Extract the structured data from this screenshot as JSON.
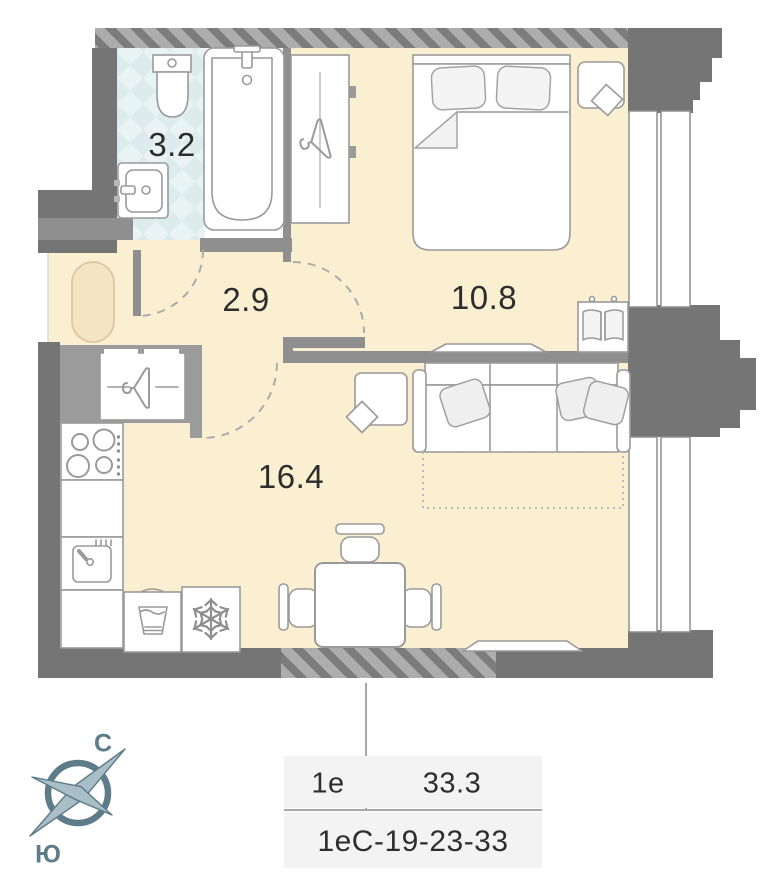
{
  "plan": {
    "type": "apartment-floor-plan",
    "rooms": {
      "bathroom": {
        "name": "bathroom",
        "area_label": "3.2"
      },
      "hallway": {
        "name": "hallway",
        "area_label": "2.9"
      },
      "bedroom": {
        "name": "bedroom",
        "area_label": "10.8"
      },
      "living_kitchen": {
        "name": "living-kitchen",
        "area_label": "16.4"
      }
    },
    "icons": [
      "toilet-icon",
      "bathtub-icon",
      "washbasin-icon",
      "hanger-icon",
      "bed-icon",
      "pillow-icon",
      "nightstand-icon",
      "tv-icon",
      "book-shelf-icon",
      "sofa-icon",
      "sofa-bed-dotted-icon",
      "side-table-icon",
      "stove-icon",
      "kitchen-sink-icon",
      "washing-machine-icon",
      "snowflake-fridge-icon",
      "dining-table-icon",
      "chair-icon",
      "rug-icon",
      "door-arc-icon",
      "window-icon",
      "compass-rose-icon"
    ]
  },
  "compass": {
    "north": "С",
    "south": "Ю"
  },
  "info_table": {
    "unit_type": "1е",
    "total_area": "33.3",
    "unit_code": "1еС-19-23-33"
  },
  "colors": {
    "floor": "#FBEFD2",
    "rug": "#F4E4C2",
    "tile": "#E9F3F3",
    "tile_alt": "#DCEBEB",
    "wall": "#757575",
    "partition": "#8F8F8F",
    "hatch_bg": "#ADADAD",
    "hatch_stripe": "#7C7C7C",
    "furniture_outline": "#9A9A9A",
    "compass": "#5E7B89",
    "compass_light": "#A9BEC6",
    "table_bg": "#F3F3F3",
    "text": "#2E2E2E"
  }
}
